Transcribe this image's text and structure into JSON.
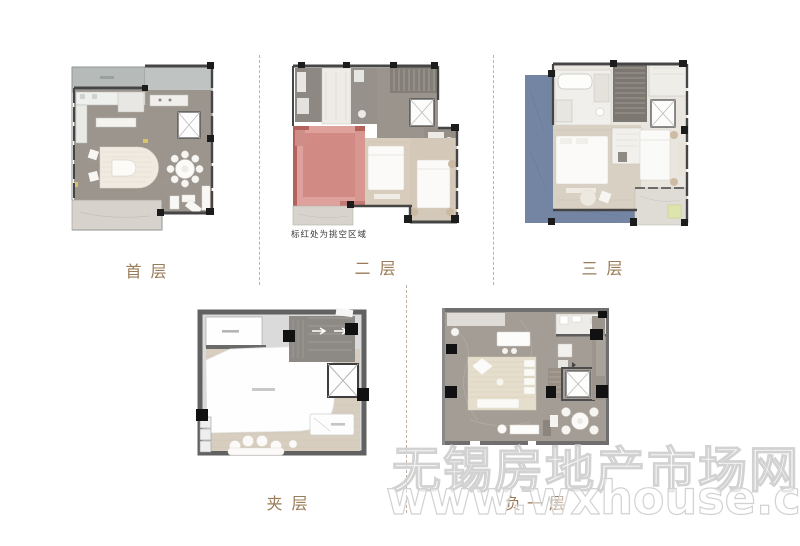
{
  "page": {
    "background": "#ffffff"
  },
  "floors": [
    {
      "id": "first",
      "label": "首层"
    },
    {
      "id": "second",
      "label": "二层",
      "note": "标红处为挑空区域"
    },
    {
      "id": "third",
      "label": "三层"
    },
    {
      "id": "mezzanine",
      "label": "夹层"
    },
    {
      "id": "basement",
      "label": "负一层"
    }
  ],
  "watermark": {
    "line1": "无锡房地产市场网",
    "line2": "www.wxhouse.com"
  },
  "colors": {
    "page_bg": "#ffffff",
    "label_gold": "#9a7c58",
    "note_text": "#3a3a3a",
    "void_red": "#dfa19b",
    "void_red_dark": "#d18b84",
    "void_red_wall": "#b4625c",
    "roof_blue": "#7385a3",
    "wall_dark": "#454545",
    "floor_marble": "#9c958d",
    "floor_wood": "#d8cec0",
    "terrace_light": "#d7d3cc",
    "terrace_bluegray": "#b6bab9",
    "stair_gray": "#837e77",
    "separator": "#b3a493",
    "watermark_stroke": "#d2d2d2",
    "highlight_yellow_green": "#dde4ae"
  }
}
